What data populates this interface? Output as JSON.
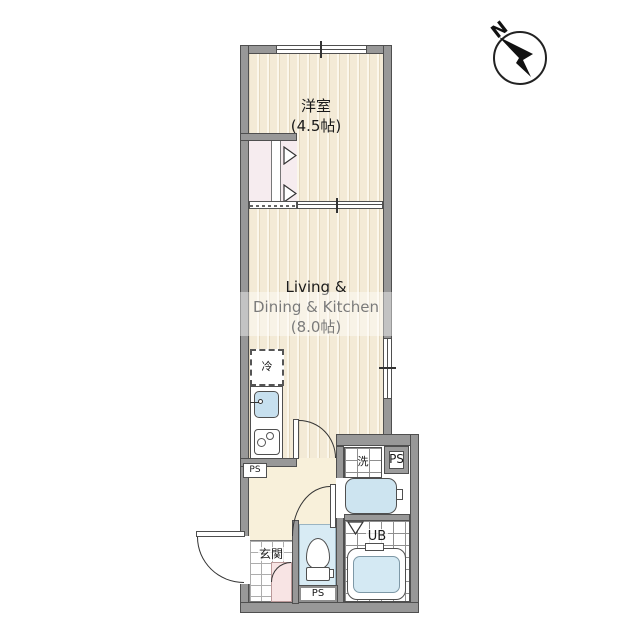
{
  "compass": {
    "north_label": "N"
  },
  "rooms": {
    "bedroom": {
      "name": "洋室",
      "size": "(4.5帖)"
    },
    "ldk": {
      "line1": "Living &",
      "line2": "Dining & Kitchen",
      "size": "(8.0帖)"
    },
    "entrance": {
      "name": "玄関"
    },
    "unit_bath": {
      "name": "UB"
    }
  },
  "fixtures": {
    "refrigerator": {
      "label": "冷"
    },
    "washer": {
      "label": "洗"
    },
    "pipe_space": {
      "label": "PS"
    }
  },
  "colors": {
    "wall": "#989898",
    "wall_outline": "#4f4f4f",
    "floor_stripe_base": "#f3ead6",
    "hallway_floor": "#f8f0da",
    "water_area_blue": "#d8ebf4",
    "fixture_blue": "#c7e0ef",
    "closet_pink": "#f6ecef",
    "entrance_step_pink": "#f8e4e4"
  }
}
